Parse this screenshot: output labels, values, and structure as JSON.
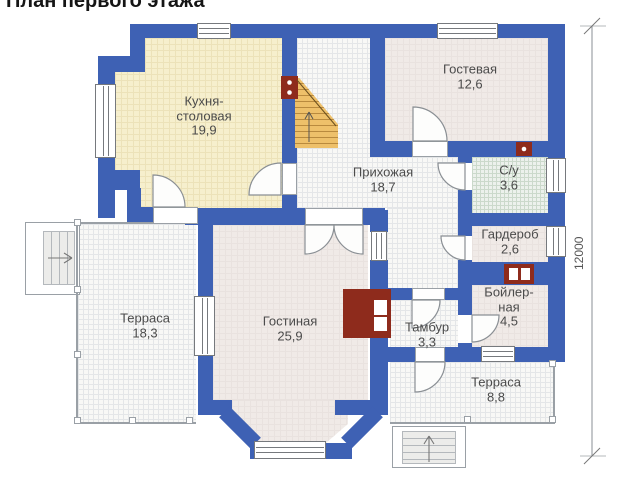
{
  "title": "План первого этажа",
  "rooms": [
    {
      "id": "kitchen",
      "name": "Кухня-\nстоловая",
      "area": "19,9"
    },
    {
      "id": "guest-room",
      "name": "Гостевая",
      "area": "12,6"
    },
    {
      "id": "hallway",
      "name": "Прихожая",
      "area": "18,7"
    },
    {
      "id": "bathroom",
      "name": "С/у",
      "area": "3,6"
    },
    {
      "id": "wardrobe",
      "name": "Гардероб",
      "area": "2,6"
    },
    {
      "id": "boiler-room",
      "name": "Бойлер-\nная",
      "area": "4,5"
    },
    {
      "id": "living-room",
      "name": "Гостиная",
      "area": "25,9"
    },
    {
      "id": "vestibule",
      "name": "Тамбур",
      "area": "3,3"
    },
    {
      "id": "terrace-left",
      "name": "Терраса",
      "area": "18,3"
    },
    {
      "id": "terrace-bottom",
      "name": "Терраса",
      "area": "8,8"
    }
  ],
  "dimension": {
    "value": "12000"
  },
  "colors": {
    "wall": "#3e61b4",
    "masonry_red": "#8e2b1c",
    "stairs_wood": "#eec06a"
  }
}
